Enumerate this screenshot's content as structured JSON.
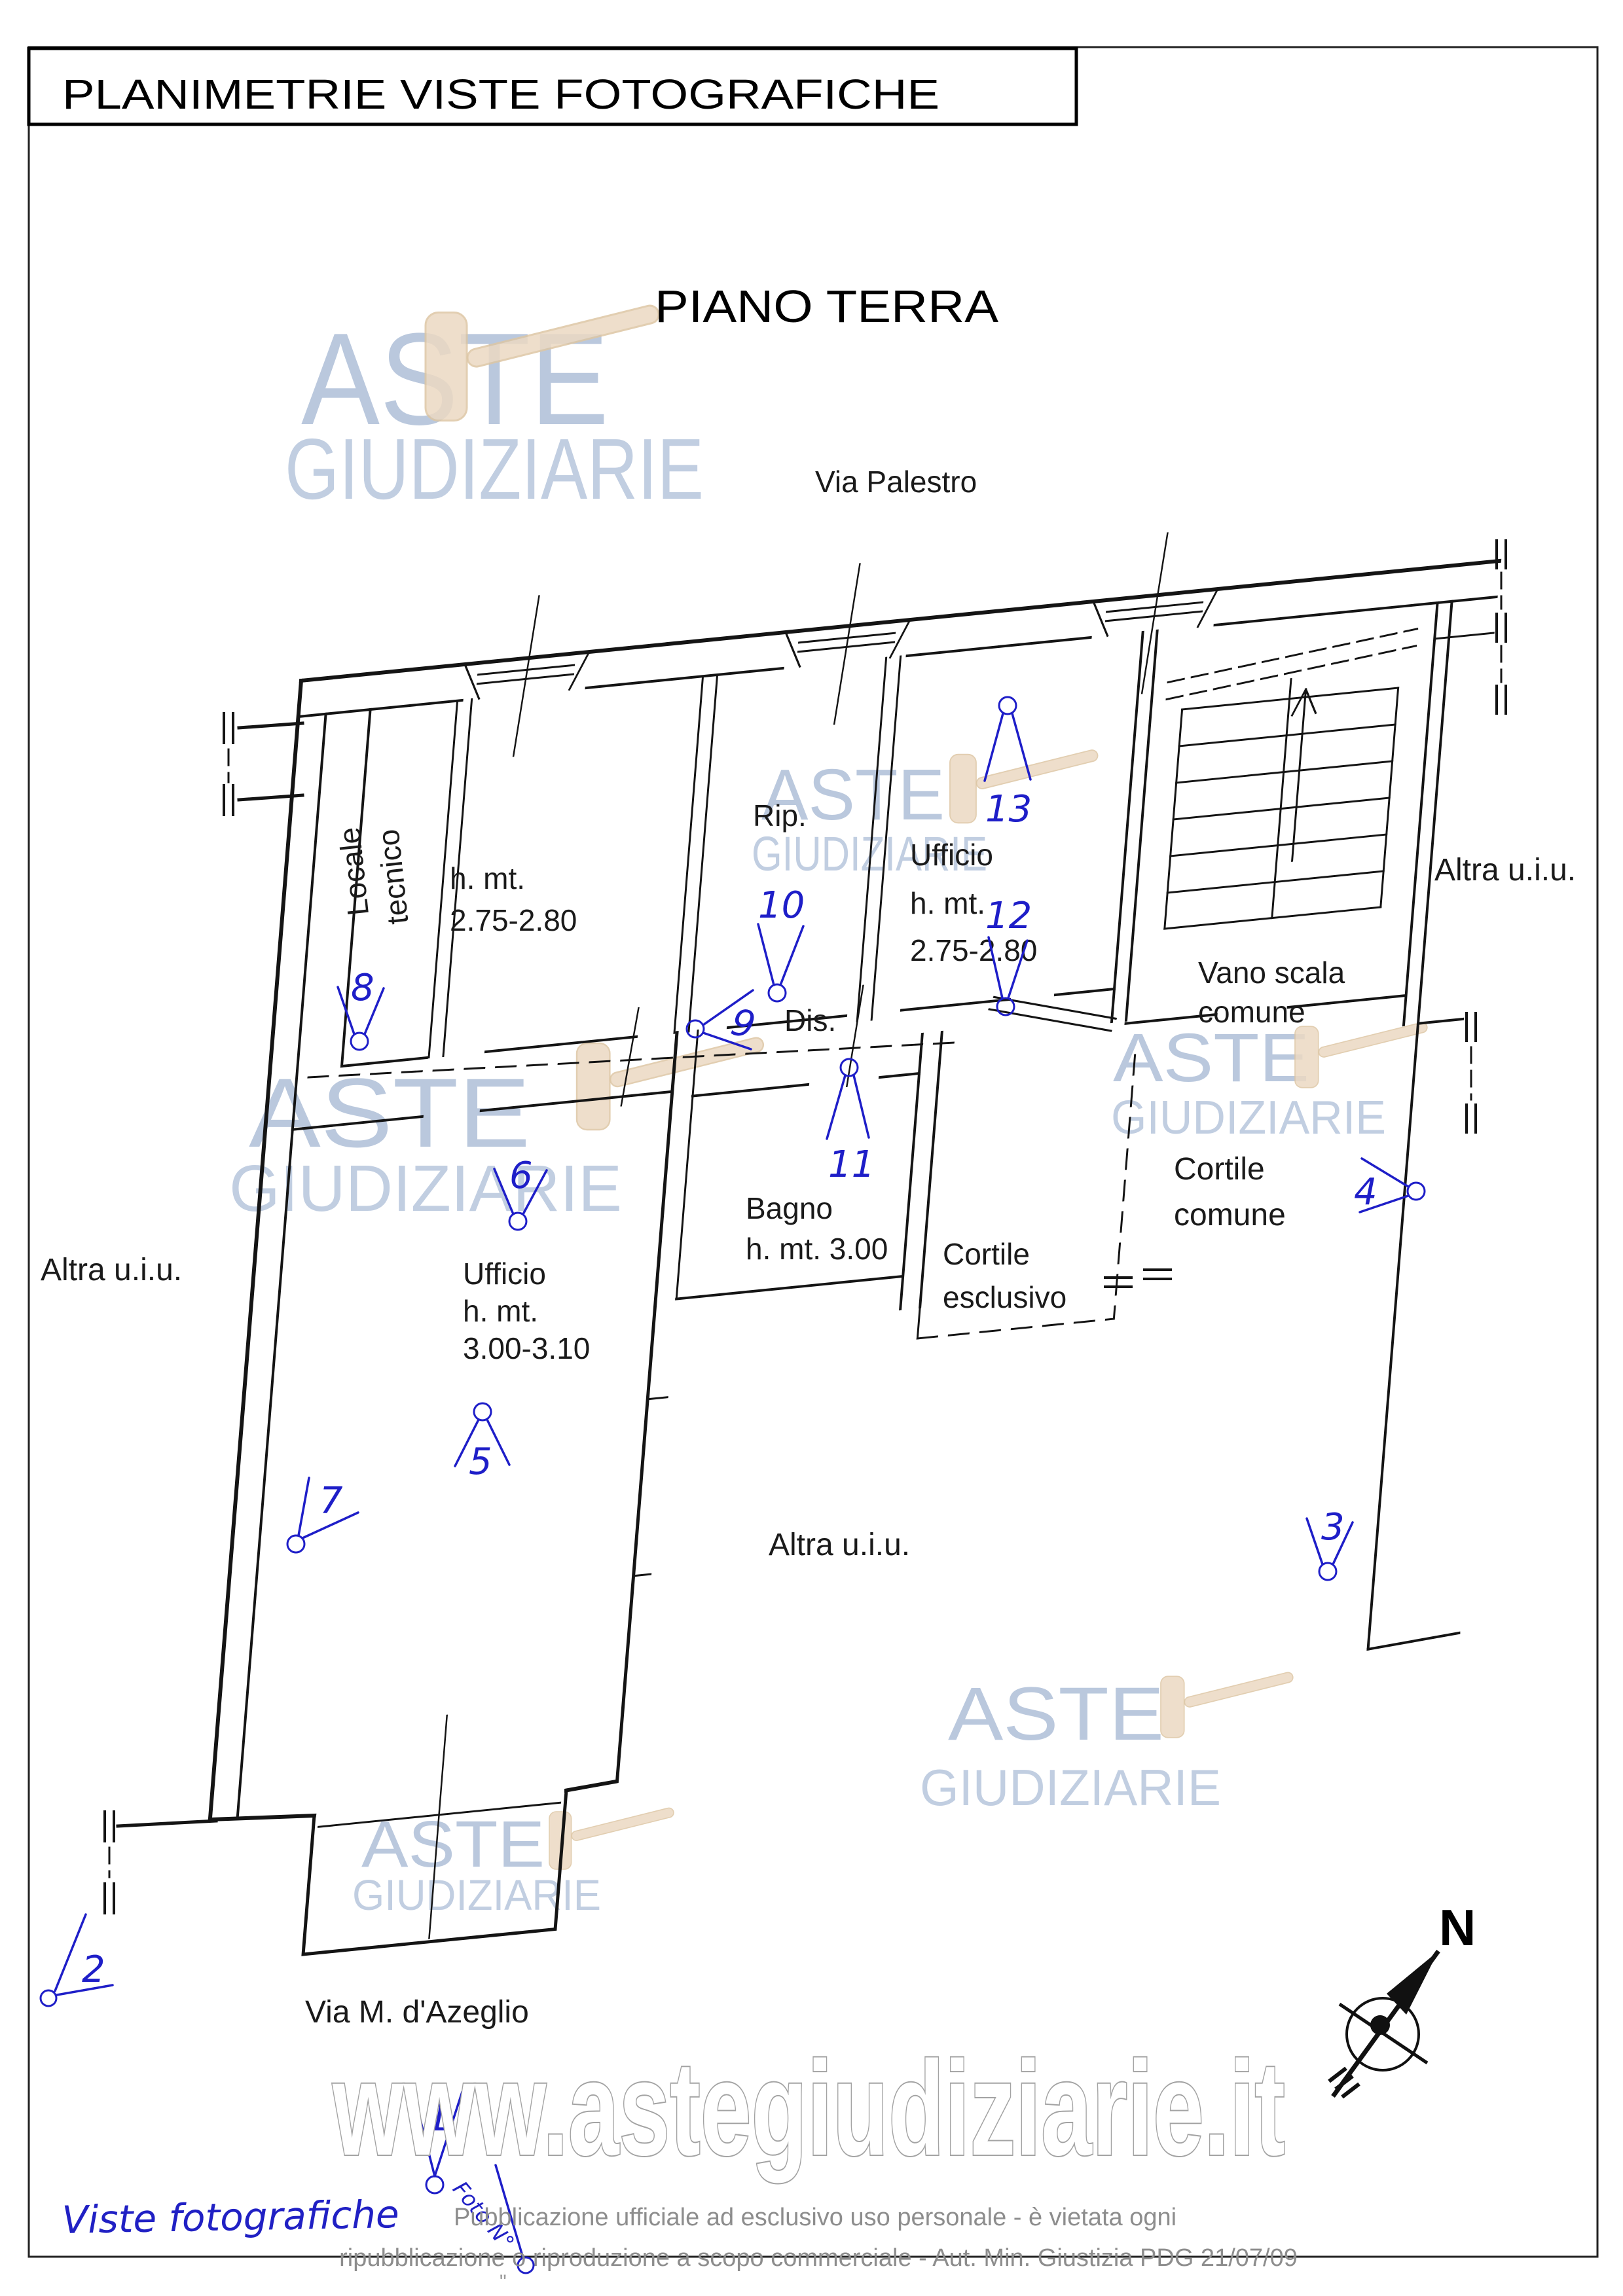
{
  "page": {
    "title": "PLANIMETRIE VISTE FOTOGRAFICHE",
    "floor_heading": "PIANO TERRA",
    "compass_label": "N",
    "legend": {
      "caption": "Viste fotografiche",
      "photo_marker_label": "Foto N°"
    },
    "watermark": {
      "logo_line1": "ASTE",
      "logo_line2": "GIUDIZIARIE",
      "url": "www.astegiudiziarie.it"
    },
    "footer": {
      "line1": "Pubblicazione ufficiale ad esclusivo uso personale - è vietata ogni",
      "line2": "ripubblicazione o riproduzione a scopo commerciale - Aut. Min. Giustizia PDG 21/07/09",
      "tiny_mark": "\""
    }
  },
  "plan": {
    "street_top": "Via Palestro",
    "street_bottom": "Via M. d'Azeglio",
    "rooms": {
      "locale_tecnico": [
        "Locale",
        "tecnico"
      ],
      "vano_275": [
        "h. mt.",
        "2.75-2.80"
      ],
      "rip": "Rip.",
      "ufficio_275": [
        "Ufficio",
        "h. mt.",
        "2.75-2.80"
      ],
      "vano_scala": [
        "Vano scala",
        "comune"
      ],
      "dis": "Dis.",
      "bagno": [
        "Bagno",
        "h. mt. 3.00"
      ],
      "cortile_esclusivo": [
        "Cortile",
        "esclusivo"
      ],
      "cortile_comune": [
        "Cortile",
        "comune"
      ],
      "ufficio_300": [
        "Ufficio",
        "h. mt.",
        "3.00-3.10"
      ],
      "altra_uiu": "Altra u.i.u."
    },
    "photo_markers": {
      "m1": "1",
      "m2": "2",
      "m3": "3",
      "m4": "4",
      "m5": "5",
      "m6": "6",
      "m7": "7",
      "m8": "8",
      "m9": "9",
      "m10": "10",
      "m11": "11",
      "m12": "12",
      "m13": "13"
    }
  }
}
